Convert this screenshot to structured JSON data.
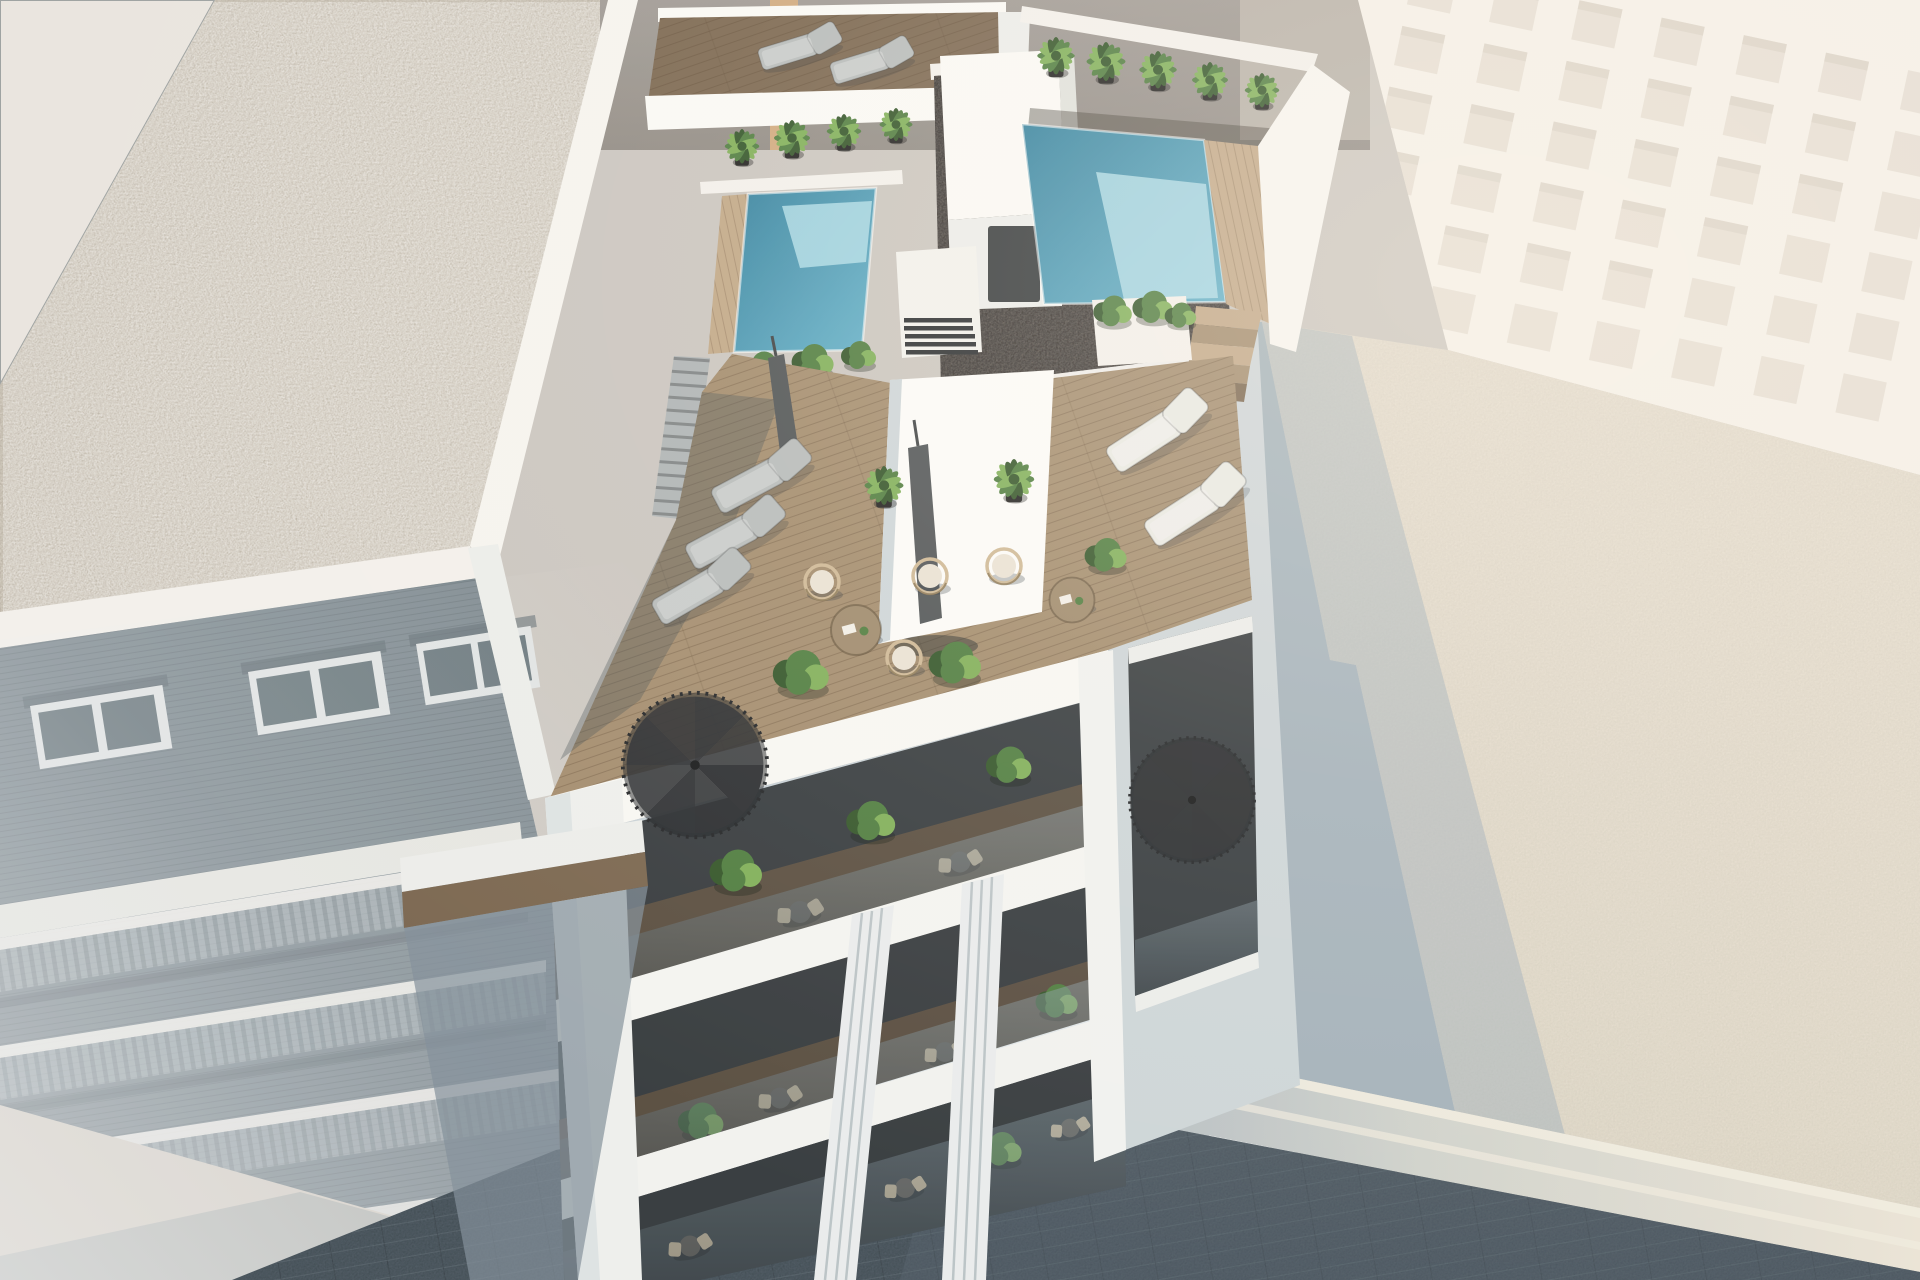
{
  "scene": {
    "type": "architectural-3d-render",
    "description": "Aerial oblique 3D visualization of a modern white new-build apartment block with a rooftop featuring two plunge pools, a dark gravel flat roof, wooden deck terraces with sun loungers, hanging wicker chairs, coffee tables, closed parasols, potted palms and two black spiral staircases; stacked glass balconies with bistro sets below; flanked by a brick apartment building with a light gravel roof on the left, a tall overexposed beige building upper right, a low flat-roofed building lower right receiving the tower's long cast shadow, and a dark paved street at the bottom.",
    "view": "high aerial, looking down at the street corner",
    "lighting": "strong midday sun from upper left, long blue shadow cast to lower right, hazy bloom on distant surfaces"
  },
  "inventory": {
    "pools": 2,
    "palm_plants_rooftop": 9,
    "sun_loungers": 7,
    "hanging_wicker_chairs": 5,
    "round_coffee_tables": 2,
    "closed_parasols": 2,
    "spiral_staircases": 2,
    "main_building_balcony_levels": 4,
    "bistro_sets": 6,
    "louvered_vent_units": 1,
    "stair_bulkheads": 1
  },
  "buildings": {
    "main": {
      "label": "white apartment block (new build)",
      "features": [
        "left plunge pool",
        "right plunge pool",
        "dark gravel roof",
        "stair bulkhead",
        "louvered vent",
        "wood deck roof terrace",
        "penthouse core wall",
        "glass balustrades",
        "fluted white pilasters",
        "black spiral staircases",
        "stacked balconies with bistro sets",
        "concrete side stair",
        "timber pool steps",
        "planter boxes"
      ]
    },
    "left_neighbor": {
      "label": "brick apartment building",
      "features": [
        "light gravel roof",
        "white parapet band",
        "shaded brick facade",
        "paired windows",
        "four rows of balconies",
        "street-level sidewalk"
      ]
    },
    "right_neighbor": {
      "label": "tall beige building",
      "features": [
        "overexposed window-grid facade"
      ]
    },
    "right_foreground": {
      "label": "low flat-roofed building",
      "features": [
        "large flat roof",
        "cast shadow of main building",
        "cornice mouldings",
        "small gravel patch at entry"
      ]
    },
    "background": {
      "label": "party wall",
      "features": [
        "grey rendered wall",
        "tan timber strip"
      ]
    }
  },
  "palette": {
    "bg": "#c9c5bf",
    "corner_roof": "#e9e5e0",
    "gravel_light": "#d8d2c7",
    "gravel_light_dot": "#a29a8b",
    "parapet_white": "#f3f1ec",
    "brick": "#74828a",
    "mid_band": "#e4e5e0",
    "window_frame": "#dfe3e4",
    "window_glass": "#5d6d74",
    "balcony_rail": "#b8c2c6",
    "sidewalk": "#d2ccc2",
    "street": "#3b4750",
    "bg_wall": "#9d9893",
    "bg_wall_dark": "#8e8983",
    "wood_strip": "#cfa87c",
    "right_bldg": "#f0eade",
    "right_bldg_win": "#d8cebf",
    "right_bldg_shade": "#c3b8a6",
    "roof_lit": "#ded7c8",
    "roof_lit2": "#e8e1d2",
    "roof_shadow": "#a2b1ba",
    "side_shadow": "#ccd5d9",
    "white_lit": "#fafaf7",
    "white_soft": "#eceeeb",
    "white_shade": "#c7d1d7",
    "pool_deep": "#2e7e9c",
    "pool_mid": "#5fb0ca",
    "pool_shallow": "#aadae8",
    "deck": "#a18a6b",
    "deck_dark": "#77634c",
    "deck_lit": "#c0a685",
    "gravel_dark": "#474240",
    "gravel_dark_lit": "#7b756e",
    "plant": "#4a7a3b",
    "plant_dark": "#2d5124",
    "plant_light": "#7cae55",
    "pot": "#1a1a1a",
    "lounger_gray": "#b5baba",
    "lounger_white": "#e8e9e4",
    "umbrella": "#4b5053",
    "stair_black": "#25282c",
    "glass": "#5f707a",
    "rail_light": "#dfe6e9",
    "interior": "#30363a",
    "floor_int": "#5a4c3d",
    "bistro_chair": "#c9b695",
    "bistro_table": "#565049",
    "steps_concrete": "#adb3b5",
    "wicker": "#cdb794",
    "cushion": "#e9e2d4",
    "table_wood": "#9c8769",
    "shadow_blue": "#5b7383"
  }
}
